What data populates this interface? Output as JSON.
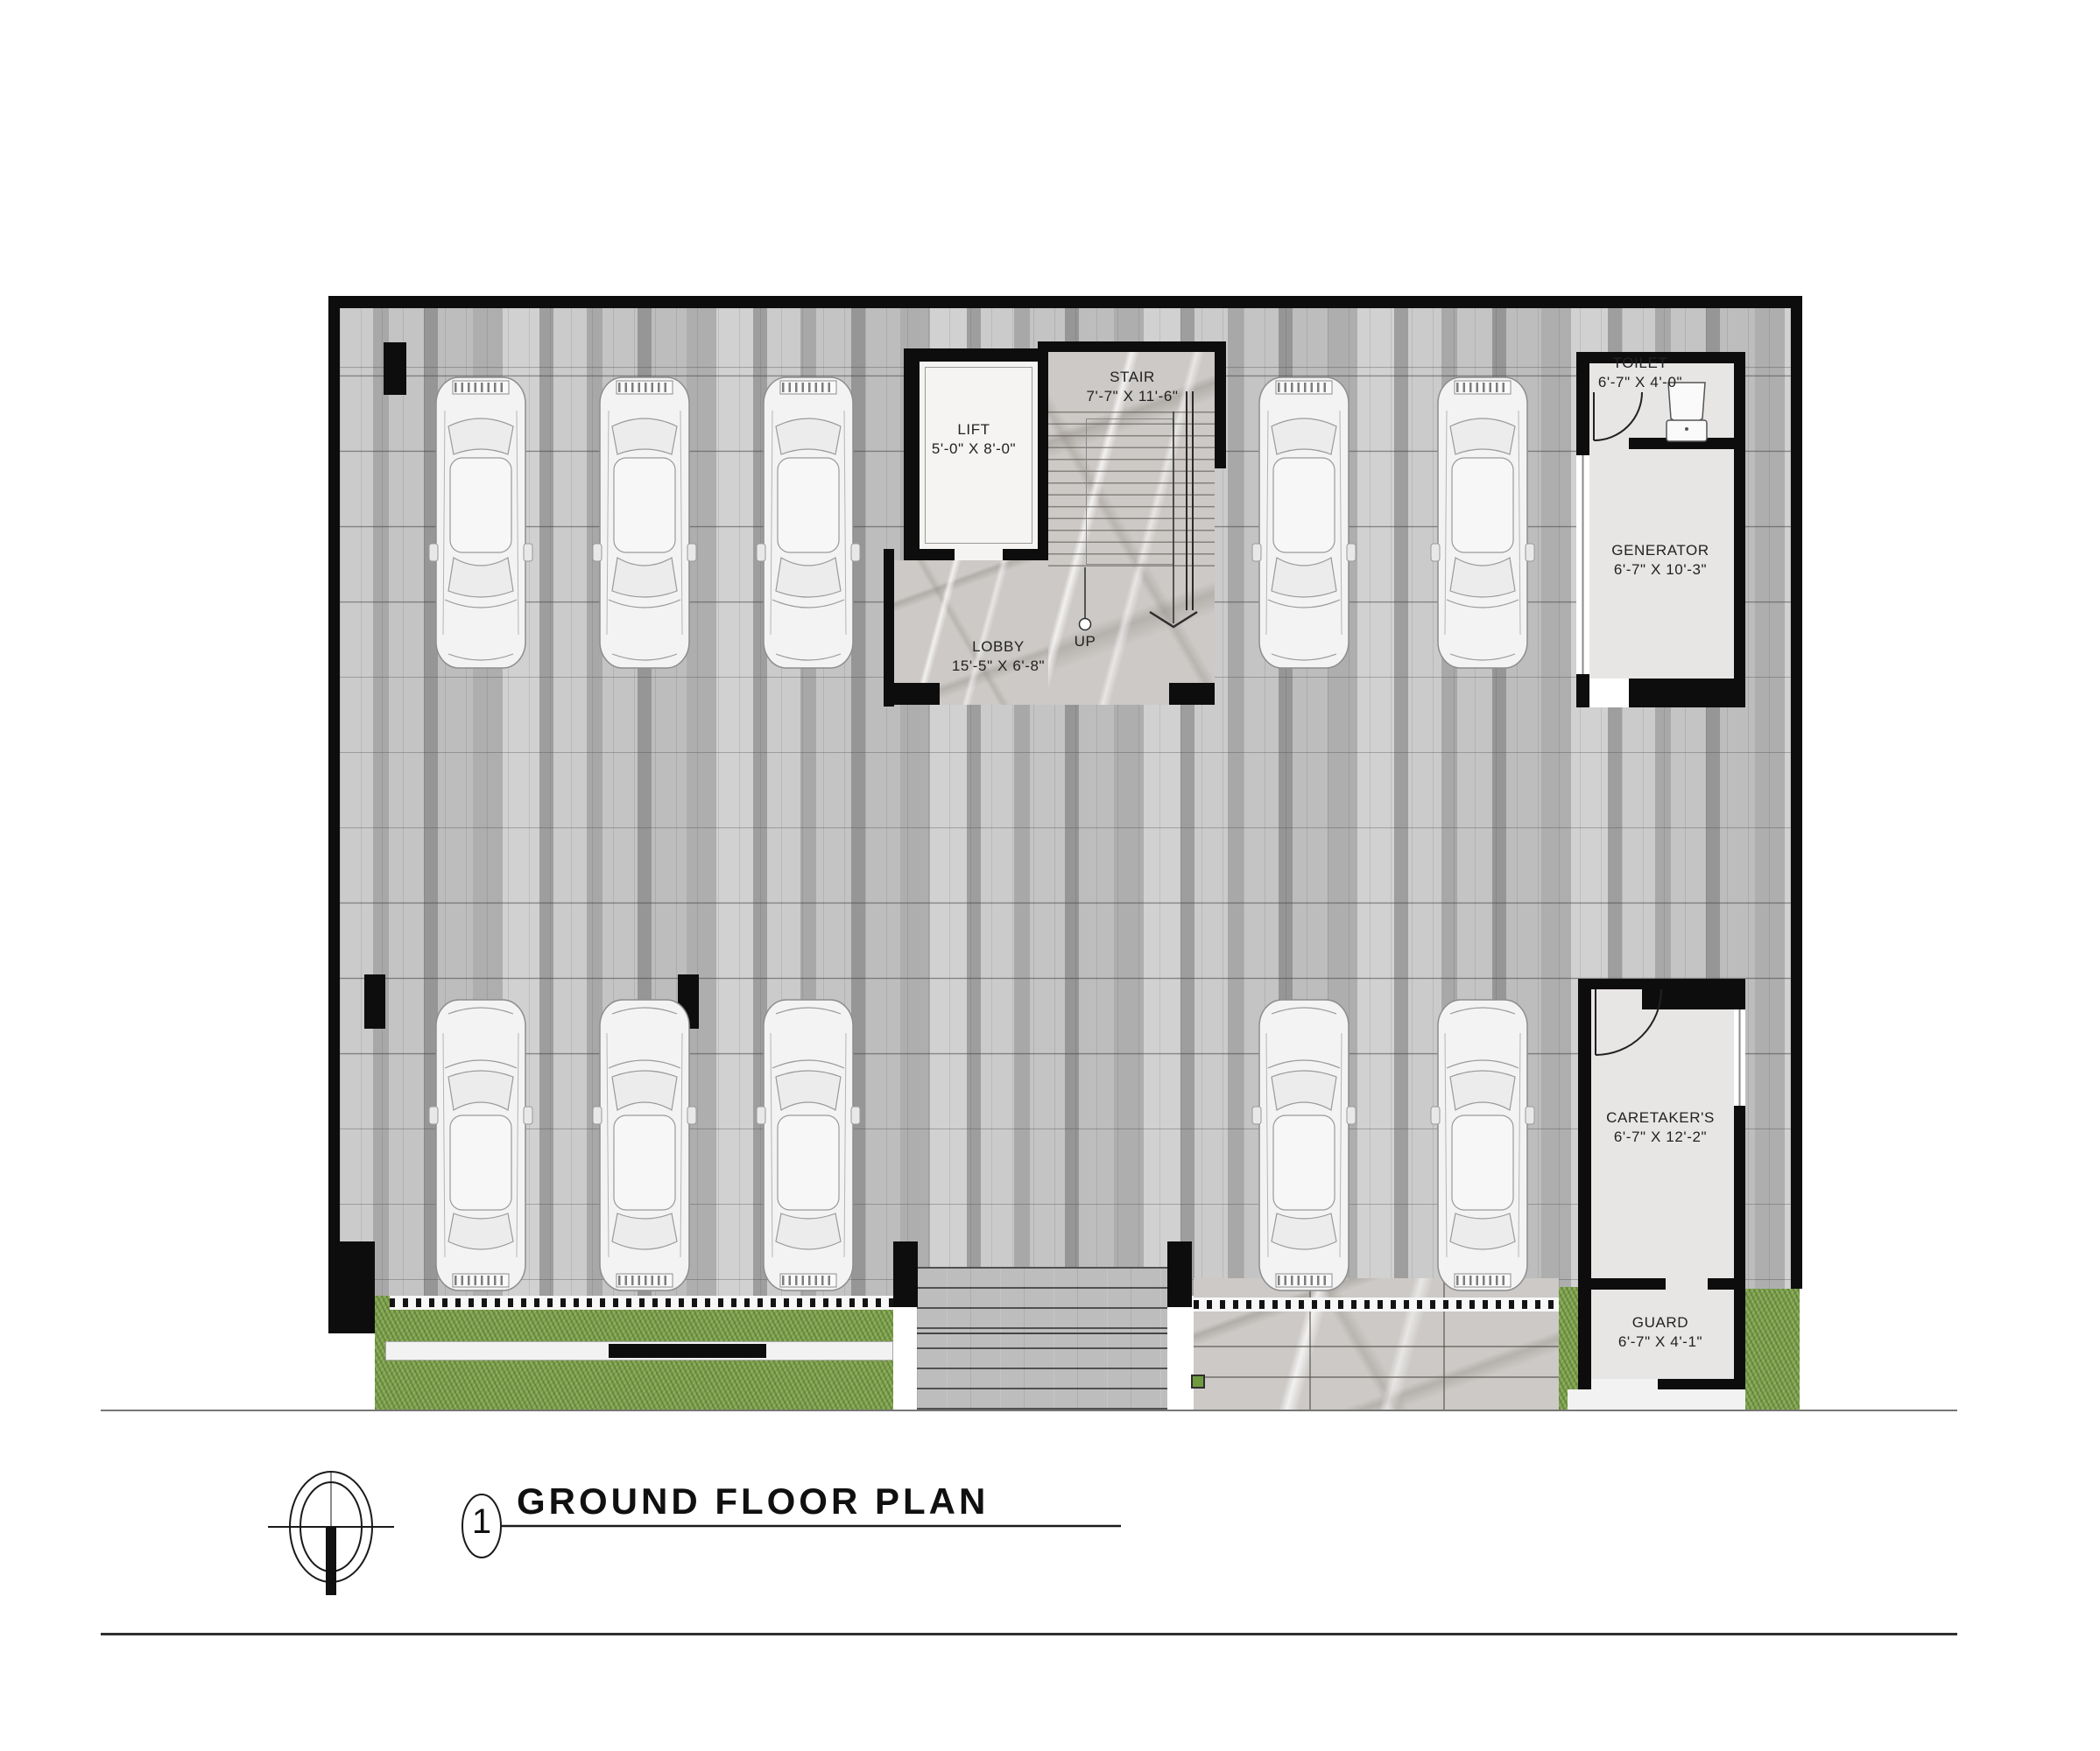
{
  "drawing": {
    "sheet": {
      "number": "1",
      "title": "GROUND FLOOR PLAN"
    },
    "rooms": {
      "lift": {
        "name": "LIFT",
        "dims": "5'-0\" X 8'-0\""
      },
      "stair": {
        "name": "STAIR",
        "dims": "7'-7\" X 11'-6\""
      },
      "lobby": {
        "name": "LOBBY",
        "dims": "15'-5\" X 6'-8\""
      },
      "toilet": {
        "name": "TOILET",
        "dims": "6'-7\" X 4'-0\""
      },
      "generator": {
        "name": "GENERATOR",
        "dims": "6'-7\" X 10'-3\""
      },
      "caretaker": {
        "name": "CARETAKER'S",
        "dims": "6'-7\" X 12'-2\""
      },
      "guard": {
        "name": "GUARD",
        "dims": "6'-7\" X 4'-1\""
      }
    },
    "annotations": {
      "stair_direction": "UP"
    },
    "palette": {
      "wall": "#0d0d0d",
      "paving_light": "#cdcdcd",
      "paving_dark": "#9b9b9b",
      "room_floor": "#e8e6e5",
      "marble": "#ccc9c6",
      "grass": "#7fa24d",
      "car_body": "#f3f3f3"
    }
  }
}
